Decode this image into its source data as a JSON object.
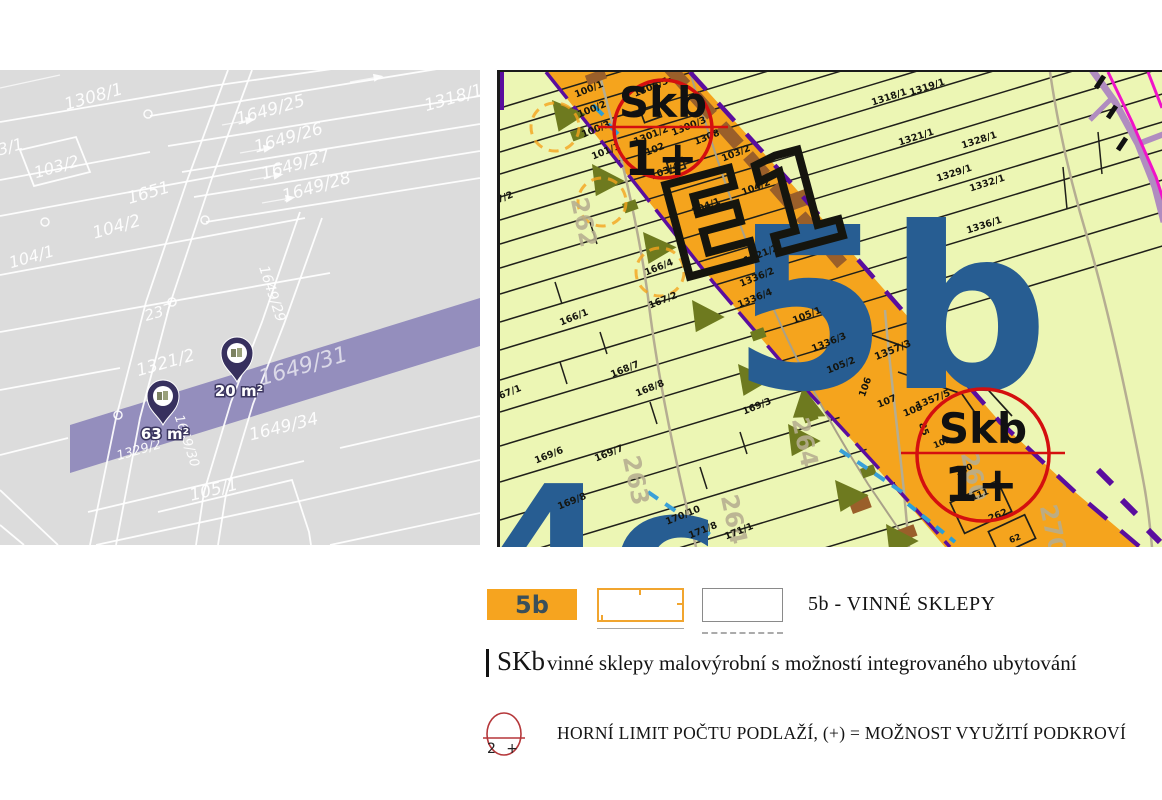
{
  "left_map": {
    "type": "cadastral",
    "background": "#dcdcdc",
    "road_band_color": "#8f89ba",
    "pin_color": "#37305e",
    "parcel_labels": [
      {
        "text": "1308/1",
        "x": 95,
        "y": 32,
        "rot": -16,
        "size": 17
      },
      {
        "text": "1649/25",
        "x": 272,
        "y": 45,
        "rot": -16,
        "size": 17
      },
      {
        "text": "1649/26",
        "x": 290,
        "y": 73,
        "rot": -16,
        "size": 17
      },
      {
        "text": "1649/27",
        "x": 297,
        "y": 100,
        "rot": -16,
        "size": 17
      },
      {
        "text": "1649/28",
        "x": 318,
        "y": 122,
        "rot": -16,
        "size": 17
      },
      {
        "text": "1318/1",
        "x": 455,
        "y": 33,
        "rot": -16,
        "size": 17
      },
      {
        "text": "3/1",
        "x": 12,
        "y": 82,
        "rot": -16,
        "size": 16
      },
      {
        "text": "103/2",
        "x": 58,
        "y": 102,
        "rot": -16,
        "size": 16
      },
      {
        "text": "1651",
        "x": 150,
        "y": 128,
        "rot": -16,
        "size": 17
      },
      {
        "text": "104/2",
        "x": 118,
        "y": 162,
        "rot": -16,
        "size": 17
      },
      {
        "text": "104/1",
        "x": 33,
        "y": 192,
        "rot": -16,
        "size": 16
      },
      {
        "text": "1649/29",
        "x": 268,
        "y": 225,
        "rot": 72,
        "size": 14
      },
      {
        "text": "237",
        "x": 160,
        "y": 247,
        "rot": -16,
        "size": 15
      },
      {
        "text": "1321/2",
        "x": 167,
        "y": 298,
        "rot": -16,
        "size": 17
      },
      {
        "text": "1649/31",
        "x": 305,
        "y": 303,
        "rot": -16,
        "size": 22,
        "color": "#dbd9e8"
      },
      {
        "text": "1649/30",
        "x": 183,
        "y": 372,
        "rot": 72,
        "size": 13
      },
      {
        "text": "1329/2",
        "x": 140,
        "y": 384,
        "rot": -16,
        "size": 13
      },
      {
        "text": "1649/34",
        "x": 285,
        "y": 362,
        "rot": -14,
        "size": 17
      },
      {
        "text": "105/1",
        "x": 215,
        "y": 425,
        "rot": -14,
        "size": 17
      }
    ],
    "pins": [
      {
        "x": 163,
        "y": 355,
        "label": "63 m²"
      },
      {
        "x": 237,
        "y": 312,
        "label": "20 m²"
      }
    ]
  },
  "right_map": {
    "type": "zoning",
    "background": "#ecf6b4",
    "zone_fill": "#f5a41d",
    "zone_code_large": "5b",
    "zone_code_color": "#275d92",
    "zone_code_partial": "4c",
    "area_code": "E1",
    "floor_limit_markers": [
      {
        "label": "Skb",
        "limit": "1+",
        "x": 163,
        "y": 57,
        "r": 49
      },
      {
        "label": "Skb",
        "limit": "1+",
        "x": 483,
        "y": 383,
        "r": 66
      }
    ],
    "parcel_labels": [
      {
        "text": "100/1",
        "x": 90,
        "y": 20
      },
      {
        "text": "100/2",
        "x": 93,
        "y": 40
      },
      {
        "text": "100/3",
        "x": 97,
        "y": 60
      },
      {
        "text": "101/1",
        "x": 107,
        "y": 82
      },
      {
        "text": "1306/5",
        "x": 152,
        "y": 18
      },
      {
        "text": "1300/3",
        "x": 190,
        "y": 57
      },
      {
        "text": "1308",
        "x": 208,
        "y": 68
      },
      {
        "text": "1301/2",
        "x": 152,
        "y": 66
      },
      {
        "text": "102",
        "x": 156,
        "y": 80
      },
      {
        "text": "103/4",
        "x": 166,
        "y": 102
      },
      {
        "text": "103/2",
        "x": 237,
        "y": 84
      },
      {
        "text": "104/2",
        "x": 257,
        "y": 118
      },
      {
        "text": "104/1",
        "x": 207,
        "y": 137
      },
      {
        "text": "1321/2",
        "x": 262,
        "y": 185
      },
      {
        "text": "1336/2",
        "x": 258,
        "y": 208
      },
      {
        "text": "1336/4",
        "x": 256,
        "y": 229
      },
      {
        "text": "166/1",
        "x": 75,
        "y": 248
      },
      {
        "text": "166/4",
        "x": 160,
        "y": 198
      },
      {
        "text": "167/2",
        "x": 164,
        "y": 231
      },
      {
        "text": "7/2",
        "x": 6,
        "y": 128
      },
      {
        "text": "167/1",
        "x": 8,
        "y": 324
      },
      {
        "text": "168/7",
        "x": 126,
        "y": 300
      },
      {
        "text": "168/8",
        "x": 151,
        "y": 319
      },
      {
        "text": "169/3",
        "x": 258,
        "y": 337
      },
      {
        "text": "169/6",
        "x": 50,
        "y": 386
      },
      {
        "text": "169/7",
        "x": 110,
        "y": 384
      },
      {
        "text": "169/8",
        "x": 73,
        "y": 432
      },
      {
        "text": "170/10",
        "x": 184,
        "y": 446
      },
      {
        "text": "171/8",
        "x": 204,
        "y": 461
      },
      {
        "text": "171/1",
        "x": 240,
        "y": 462
      },
      {
        "text": "1318/1",
        "x": 390,
        "y": 28,
        "rot": -18
      },
      {
        "text": "1319/1",
        "x": 428,
        "y": 18,
        "rot": -18
      },
      {
        "text": "1321/1",
        "x": 417,
        "y": 68,
        "rot": -18
      },
      {
        "text": "1328/1",
        "x": 480,
        "y": 71,
        "rot": -18
      },
      {
        "text": "1329/1",
        "x": 455,
        "y": 104,
        "rot": -18
      },
      {
        "text": "1332/1",
        "x": 488,
        "y": 114,
        "rot": -18
      },
      {
        "text": "1336/1",
        "x": 485,
        "y": 156,
        "rot": -18
      },
      {
        "text": "105/1",
        "x": 308,
        "y": 246
      },
      {
        "text": "1336/3",
        "x": 330,
        "y": 273
      },
      {
        "text": "105/2",
        "x": 342,
        "y": 296
      },
      {
        "text": "106",
        "x": 368,
        "y": 316,
        "rot": -70
      },
      {
        "text": "107",
        "x": 388,
        "y": 332
      },
      {
        "text": "108",
        "x": 414,
        "y": 341
      },
      {
        "text": "1357/3",
        "x": 394,
        "y": 281,
        "size": 10
      },
      {
        "text": "1357/5",
        "x": 434,
        "y": 330
      },
      {
        "text": "85",
        "x": 421,
        "y": 358,
        "rot": 70
      },
      {
        "text": "109",
        "x": 443,
        "y": 373,
        "size": 8.5
      },
      {
        "text": "110",
        "x": 465,
        "y": 400,
        "size": 8.5
      },
      {
        "text": "111",
        "x": 481,
        "y": 425,
        "size": 8.5
      },
      {
        "text": "262",
        "x": 499,
        "y": 446
      },
      {
        "text": "62",
        "x": 516,
        "y": 469,
        "size": 8.5
      }
    ],
    "contour_labels": [
      {
        "text": "262",
        "x": 76,
        "y": 152
      },
      {
        "text": "263",
        "x": 128,
        "y": 410
      },
      {
        "text": "264",
        "x": 226,
        "y": 449
      },
      {
        "text": "264",
        "x": 297,
        "y": 372
      },
      {
        "text": "260",
        "x": 466,
        "y": 406
      },
      {
        "text": "270",
        "x": 545,
        "y": 459
      }
    ]
  },
  "legend": {
    "zone": {
      "code": "5b",
      "text": "5b - VINNÉ SKLEPY"
    },
    "skb": {
      "code": "SKb",
      "text": "vinné sklepy malovýrobní s možností integrovaného ubytování"
    },
    "floor_limit": {
      "symbol": "2 +",
      "text": "HORNÍ LIMIT POČTU PODLAŽÍ, (+) = MOŽNOST VYUŽITÍ PODKROVÍ"
    }
  }
}
